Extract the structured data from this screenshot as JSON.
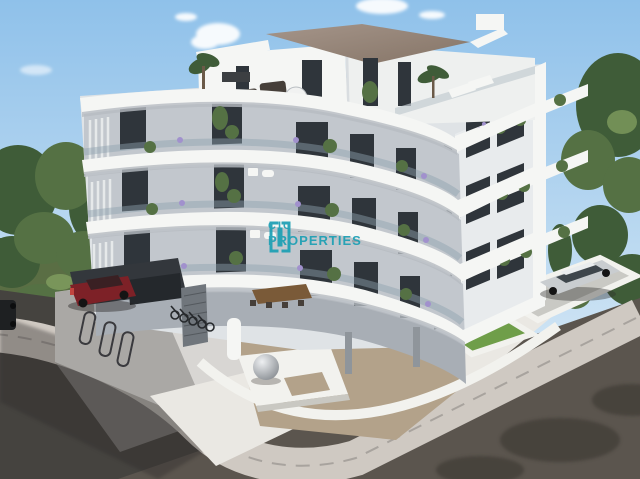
{
  "watermark": {
    "logo_icon": "cic-brackets-logo",
    "line1": "CIC",
    "line2": "PROPERTIES",
    "color": "#1b9fb4"
  },
  "palette": {
    "sky_top": "#8fc1ea",
    "sky_bottom": "#cfe4f4",
    "cloud_white": "#ffffff",
    "foliage_dark": "#3f5c38",
    "foliage_mid": "#557144",
    "foliage_light": "#7f9c5e",
    "scrub_green": "#5a6e44",
    "building_white": "#f5f6f4",
    "building_shade": "#dfe3e6",
    "facade_recess": "#c2c7cd",
    "facade_dark": "#a8aeb5",
    "window_dark": "#2f353b",
    "glass_tint": "#8fa3af",
    "roof_deck_brown": "#93826f",
    "road_dark": "#45433f",
    "road_warm": "#5b554e",
    "sidewalk_light": "#cfc9c2",
    "plaza_tile": "#d8d6d3",
    "gravel_beige": "#b3a28a",
    "pebble_white": "#eae8e3",
    "lawn_green": "#6f9e49",
    "wall_white": "#f2f2ee",
    "red_car": "#7d2127",
    "silver_car": "#c9cdd0",
    "dark_car": "#1e2022",
    "furniture_dark": "#463f39",
    "table_black": "#23262a",
    "wood_brown": "#7a5a38",
    "lavender": "#a191cd",
    "steel_gray": "#8f959b"
  }
}
